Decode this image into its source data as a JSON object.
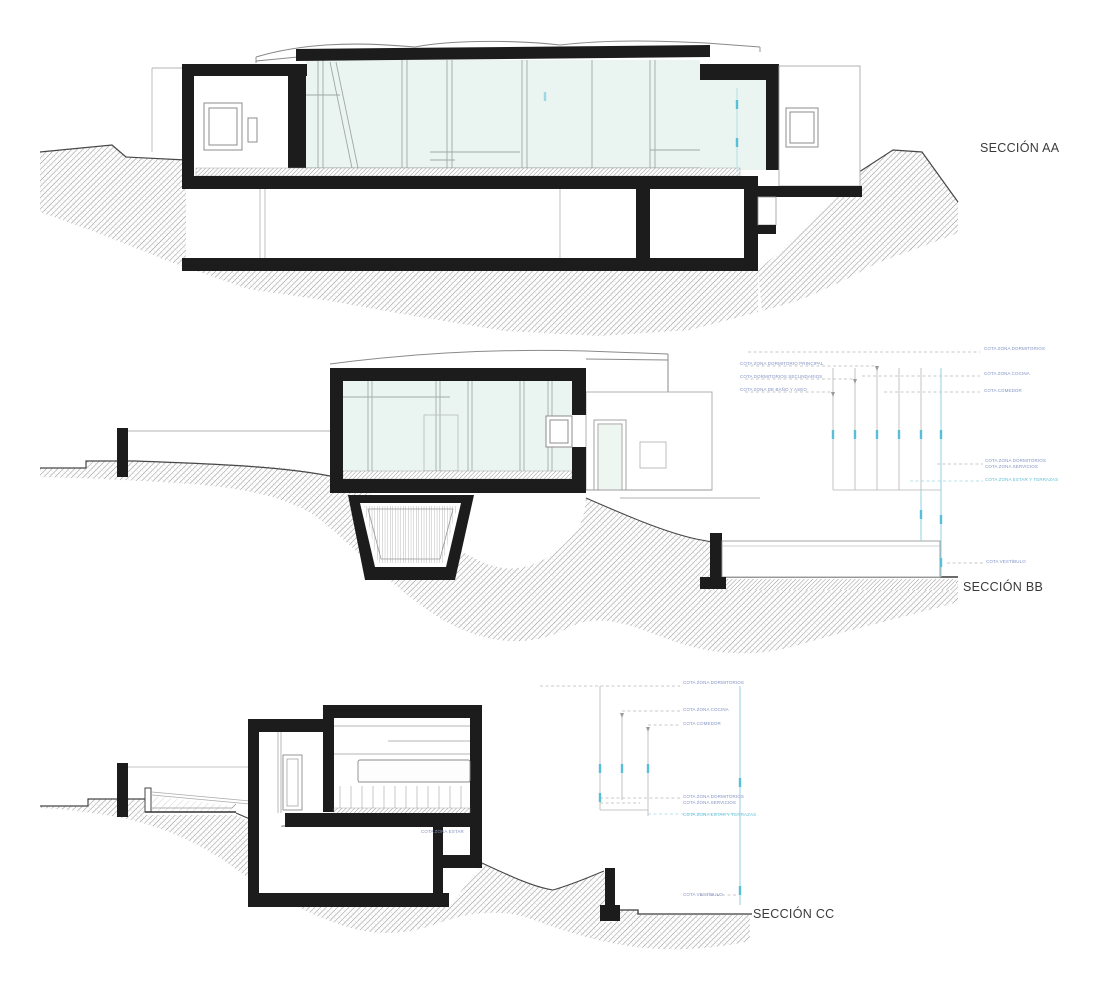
{
  "drawing": {
    "type": "architectural-sections",
    "sections": {
      "aa": {
        "title": "SECCIÓN AA"
      },
      "bb": {
        "title": "SECCIÓN BB"
      },
      "cc": {
        "title": "SECCIÓN CC"
      }
    }
  },
  "annotations": {
    "bb_left": [
      "COTA ZONA DORMITORIO PRINCIPAL",
      "COTA DORMITORIOS SECUNDARIOS",
      "COTA ZONA DE BAÑO Y ASEO"
    ],
    "bb_right_top": [
      "COTA ZONA DORMITORIOS",
      "COTA ZONA COCINA",
      "COTA COMEDOR"
    ],
    "bb_right_mid": [
      "COTA ZONA DORMITORIOS",
      "COTA ZONA SERVICIOS",
      "COTA ZONA ESTAR Y TERRAZAS"
    ],
    "bb_right_low": [
      "COTA VESTÍBULO"
    ],
    "cc_top": [
      "COTA ZONA DORMITORIOS",
      "COTA ZONA COCINA",
      "COTA COMEDOR"
    ],
    "cc_mid": [
      "COTA ZONA DORMITORIOS",
      "COTA ZONA SERVICIOS",
      "COTA ZONA ESTAR Y TERRAZAS"
    ],
    "cc_low": [
      "COTA VESTÍBULO"
    ],
    "cc_room_note": "COTA ZONA ESTAR"
  },
  "colors": {
    "cut_black": "#1c1c1c",
    "thin_gray": "#9a9a9a",
    "glazing_tint": "#eaf4f0",
    "dimension_cyan": "#6cc4d8",
    "annotation_blue": "#8494c4",
    "title_gray": "#3a3a3a"
  }
}
